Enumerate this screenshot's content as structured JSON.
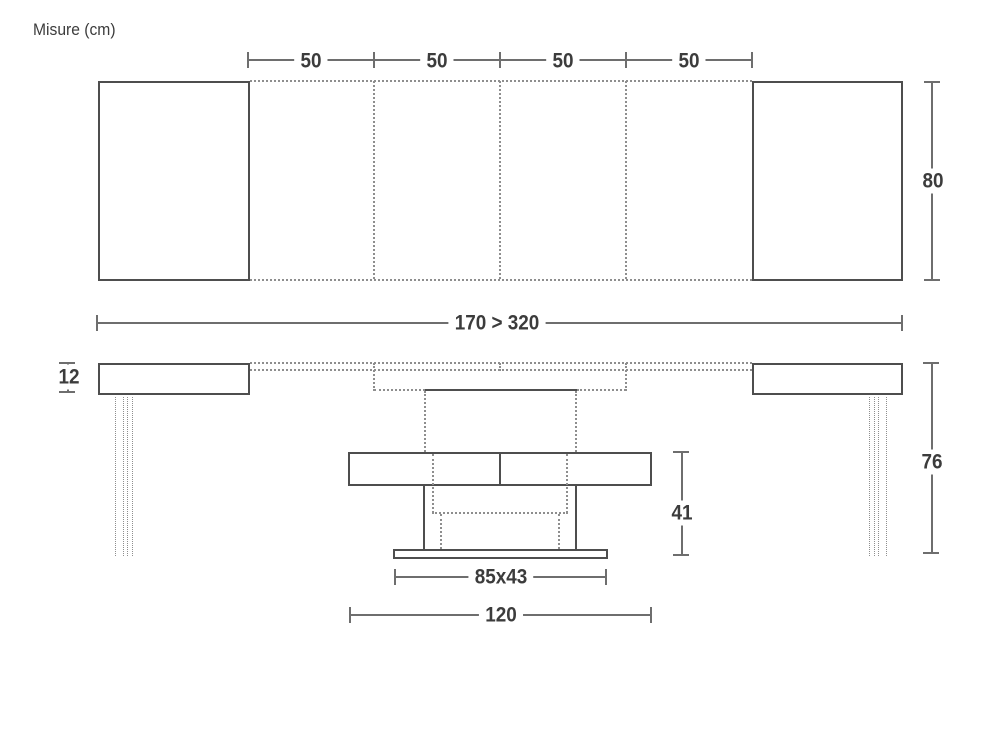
{
  "title": "Misure (cm)",
  "colors": {
    "line": "#4e4e4e",
    "dim": "#6e6e6e",
    "dash": "#8e8e8e",
    "text": "#3c3c3c",
    "background": "#ffffff"
  },
  "top_view": {
    "segment_labels": [
      "50",
      "50",
      "50",
      "50"
    ],
    "depth_label": "80",
    "length_label": "170 > 320"
  },
  "side_view": {
    "thickness_label": "12",
    "height_label": "76",
    "pedestal_height_label": "41",
    "base_plate_label": "85x43",
    "base_width_label": "120"
  }
}
